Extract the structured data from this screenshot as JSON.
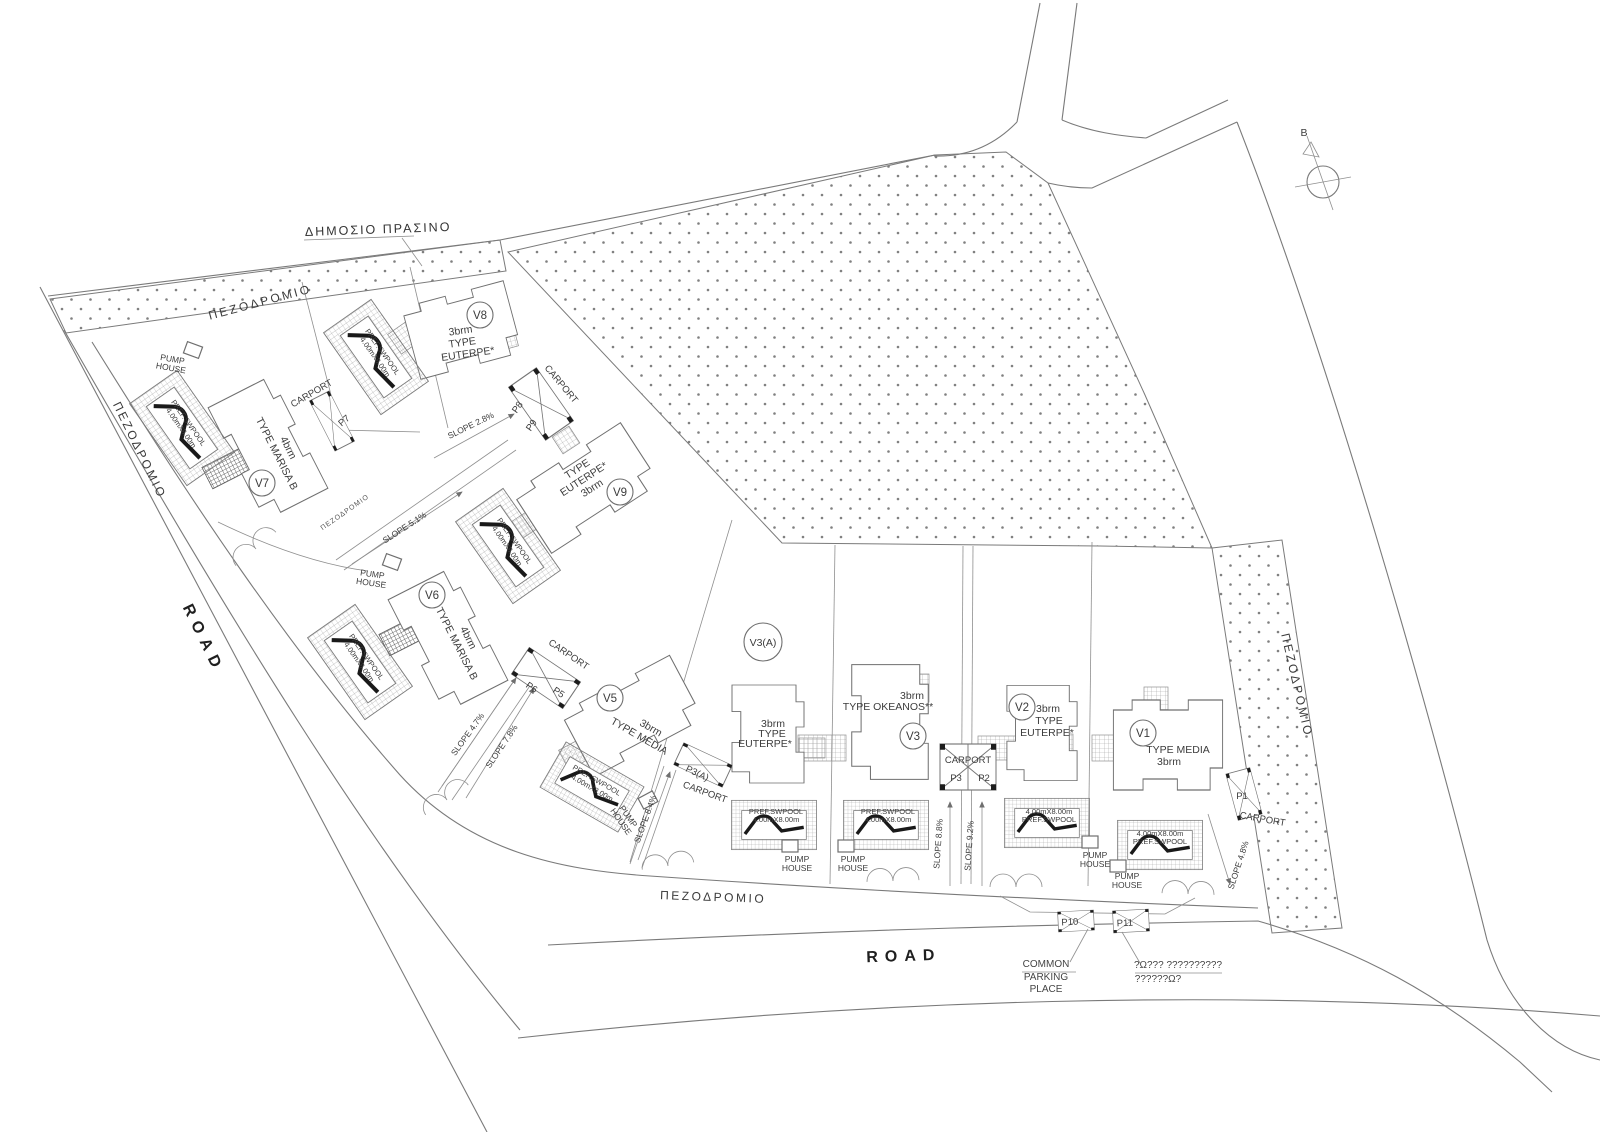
{
  "labels": {
    "road": "ROAD",
    "walkway": "ΠΕΖΟΔΡΟΜΙΟ",
    "public_green": "ΔΗΜΟΣΙΟ ΠΡΑΣΙΝΟ",
    "compass_north": "B",
    "carport": "CARPORT",
    "pump_line1": "PUMP",
    "pump_line2": "HOUSE",
    "pool_line1": "PREF.SWPOOL",
    "pool_line2": "4.00mX8.00m",
    "common_line1": "COMMON",
    "common_line2": "PARKING",
    "common_line3": "PLACE",
    "note_line1": "?Ω??? ??????????",
    "note_line2": "??????Ω?"
  },
  "villas": [
    {
      "id": "V8",
      "line1": "3brm",
      "line2": "TYPE",
      "line3": "EUTERPE*"
    },
    {
      "id": "V7",
      "line1": "4brm",
      "line2": "TYPE MARISA B",
      "line3": ""
    },
    {
      "id": "V9",
      "line1": "TYPE",
      "line2": "EUTERPE*",
      "line3": "3brm"
    },
    {
      "id": "V6",
      "line1": "4brm",
      "line2": "TYPE MARISA B",
      "line3": ""
    },
    {
      "id": "V5",
      "line1": "3brm",
      "line2": "TYPE MEDIA",
      "line3": ""
    },
    {
      "id": "V3(A)",
      "line1": "3brm",
      "line2": "TYPE",
      "line3": "EUTERPE*"
    },
    {
      "id": "V3",
      "line1": "3brm",
      "line2": "TYPE OKEANOS**",
      "line3": ""
    },
    {
      "id": "V2",
      "line1": "3brm",
      "line2": "TYPE",
      "line3": "EUTERPE*"
    },
    {
      "id": "V1",
      "line1": "TYPE MEDIA",
      "line2": "3brm",
      "line3": ""
    }
  ],
  "parking": {
    "p1": "P1",
    "p2": "P2",
    "p3": "P3",
    "p3a": "P3(A)",
    "p5": "P5",
    "p6": "P6",
    "p7": "P7",
    "p8": "P8",
    "p9": "P9",
    "p10": "P10",
    "p11": "P11"
  },
  "slopes": {
    "s28": "SLOPE 2.8%",
    "s51": "SLOPE 5.1%",
    "s47": "SLOPE 4.7%",
    "s78": "SLOPE 7.8%",
    "s84": "SLOPE 8.4%",
    "s88": "SLOPE 8.8%",
    "s92": "SLOPE 9.2%",
    "s48": "SLOPE 4.8%"
  }
}
